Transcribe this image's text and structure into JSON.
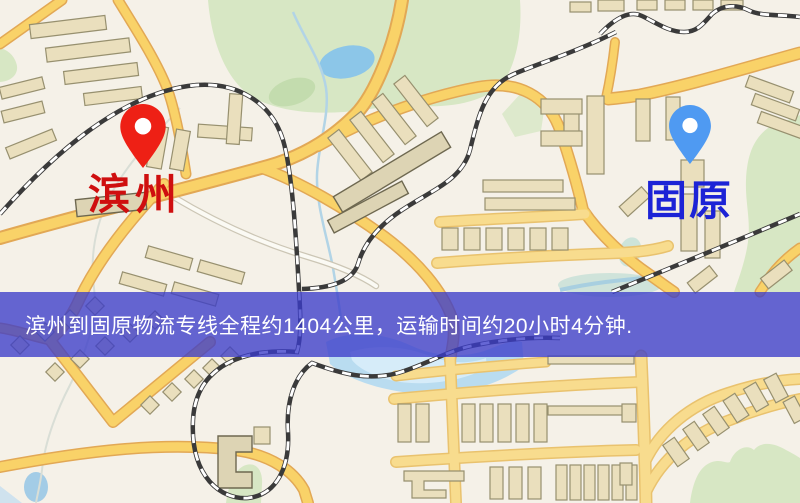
{
  "map": {
    "origin": {
      "name": "滨州",
      "marker_color": "#ee2015",
      "label_color": "#cf0f0f"
    },
    "destination": {
      "name": "固原",
      "marker_color": "#4f9af2",
      "label_color": "#1c23d6"
    },
    "banner": {
      "text": "滨州到固原物流专线全程约1404公里，运输时间约20小时4分钟.",
      "background_color": "#3b3cc9",
      "text_color": "#ffffff",
      "distance_text": "约1404公里",
      "duration_text": "约20小时4分钟"
    }
  }
}
